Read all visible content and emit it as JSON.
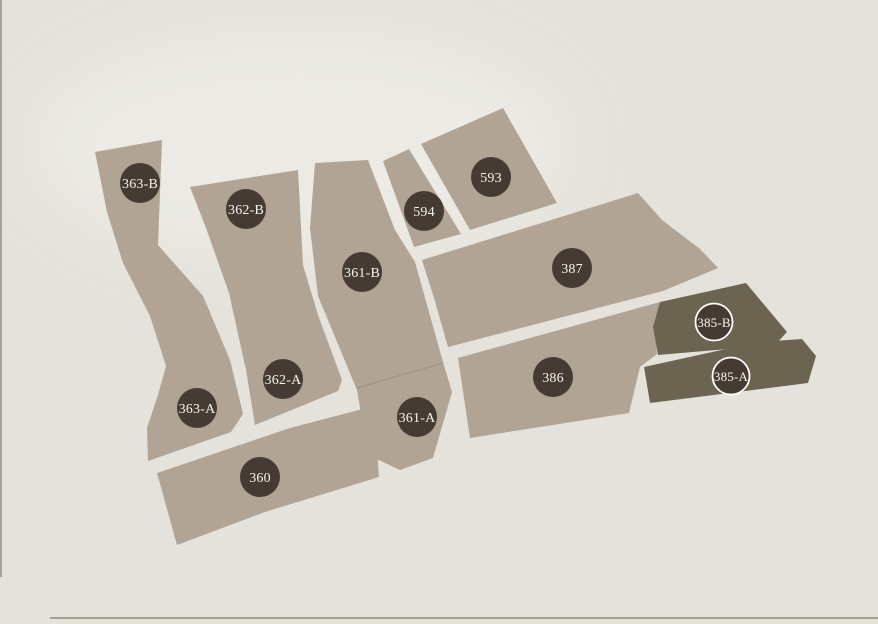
{
  "map": {
    "parcels": [
      {
        "label": "363-B",
        "highlighted": false
      },
      {
        "label": "362-B",
        "highlighted": false
      },
      {
        "label": "361-B",
        "highlighted": false
      },
      {
        "label": "594",
        "highlighted": false
      },
      {
        "label": "593",
        "highlighted": false
      },
      {
        "label": "387",
        "highlighted": false
      },
      {
        "label": "385-B",
        "highlighted": true
      },
      {
        "label": "385-A",
        "highlighted": true
      },
      {
        "label": "386",
        "highlighted": false
      },
      {
        "label": "362-A",
        "highlighted": false
      },
      {
        "label": "363-A",
        "highlighted": false
      },
      {
        "label": "361-A",
        "highlighted": false
      },
      {
        "label": "360",
        "highlighted": false
      }
    ],
    "colors": {
      "background": "#e4e2db",
      "parcel": "#b2a494",
      "parcel_highlighted": "#6b6450",
      "marker": "#453b33",
      "marker_text": "#f6f4ef",
      "marker_ring": "#ffffff"
    }
  }
}
